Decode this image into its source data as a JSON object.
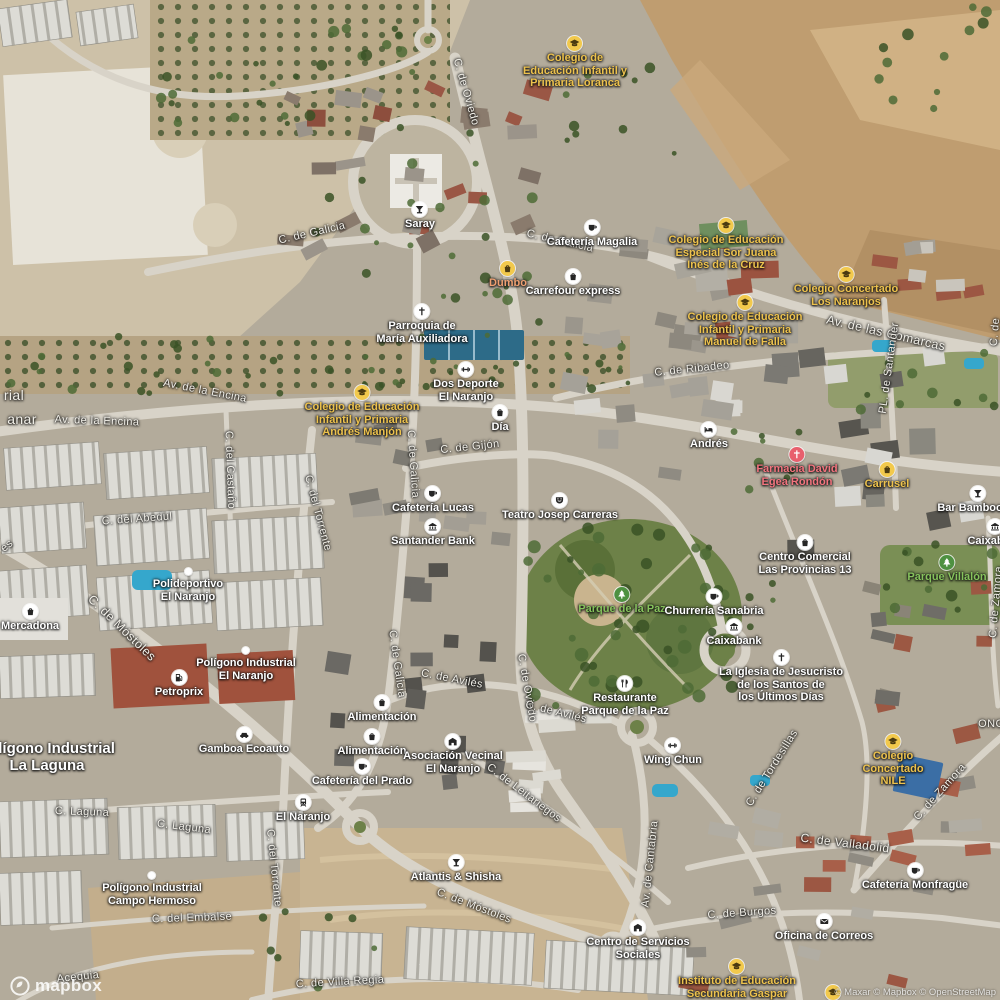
{
  "map": {
    "logo_text": "mapbox",
    "attribution": "© Maxar © Mapbox © OpenStreetMap",
    "palette": {
      "street_text": "#f2f0e9",
      "poi_text": "#ffffff",
      "school_yellow": "#edc24d",
      "park_green": "#86c35c",
      "pharmacy_red": "#f3747e",
      "shop_orange": "#efa071",
      "road": "#d8d3c8"
    },
    "street_labels": [
      {
        "text": "C. de Oviedo",
        "x": 466,
        "y": 92,
        "r": 74
      },
      {
        "text": "C. de Galicia",
        "x": 312,
        "y": 233,
        "r": -13
      },
      {
        "text": "C. de Galicia",
        "x": 560,
        "y": 241,
        "r": 13
      },
      {
        "text": "Av. de las Comarcas",
        "x": 886,
        "y": 333,
        "r": 13,
        "size": 12.5
      },
      {
        "text": "C. de Ribadeo",
        "x": 692,
        "y": 369,
        "r": -6
      },
      {
        "text": "PL. de Santander",
        "x": 889,
        "y": 368,
        "r": -82
      },
      {
        "text": "Av. de la Encina",
        "x": 205,
        "y": 391,
        "r": 11
      },
      {
        "text": "Av. de la Encina",
        "x": 97,
        "y": 421,
        "r": 2
      },
      {
        "text": "C. del Castaño",
        "x": 230,
        "y": 470,
        "r": 88
      },
      {
        "text": "C. del Abedul",
        "x": 137,
        "y": 519,
        "r": -4
      },
      {
        "text": "C. de Galicia",
        "x": 413,
        "y": 464,
        "r": 86
      },
      {
        "text": "C. de Gijón",
        "x": 470,
        "y": 447,
        "r": -6
      },
      {
        "text": "C. del Torrente",
        "x": 318,
        "y": 513,
        "r": 75
      },
      {
        "text": "C. de Móstoles",
        "x": 122,
        "y": 628,
        "r": 44,
        "size": 12.5
      },
      {
        "text": "C. de Galicia",
        "x": 397,
        "y": 664,
        "r": 82
      },
      {
        "text": "C. de Avilés",
        "x": 452,
        "y": 679,
        "r": 11
      },
      {
        "text": "C. de Oviedo",
        "x": 527,
        "y": 688,
        "r": 80
      },
      {
        "text": "C. de Avilés",
        "x": 556,
        "y": 712,
        "r": 14
      },
      {
        "text": "C. de Leitariegos",
        "x": 524,
        "y": 793,
        "r": 37
      },
      {
        "text": "C. de Tordesillas",
        "x": 772,
        "y": 768,
        "r": -58
      },
      {
        "text": "C. del Torrente",
        "x": 274,
        "y": 868,
        "r": 84
      },
      {
        "text": "C. Laguna",
        "x": 82,
        "y": 812,
        "r": 2
      },
      {
        "text": "C. Laguna",
        "x": 184,
        "y": 827,
        "r": 7
      },
      {
        "text": "Av. de Cantabria",
        "x": 650,
        "y": 864,
        "r": -84
      },
      {
        "text": "C. de Móstoles",
        "x": 474,
        "y": 906,
        "r": 21
      },
      {
        "text": "C. de Zamora",
        "x": 940,
        "y": 792,
        "r": -48
      },
      {
        "text": "C. de Valladolid",
        "x": 845,
        "y": 843,
        "r": 7,
        "size": 12
      },
      {
        "text": "C. de Burgos",
        "x": 742,
        "y": 913,
        "r": -4
      },
      {
        "text": "C. del Embalse",
        "x": 192,
        "y": 918,
        "r": -2
      },
      {
        "text": "C. de Villa Regia",
        "x": 340,
        "y": 982,
        "r": -3
      },
      {
        "text": "Acequia",
        "x": 78,
        "y": 977,
        "r": -6
      },
      {
        "text": "C. de Zamora",
        "x": 996,
        "y": 602,
        "r": -85
      },
      {
        "text": "C. de",
        "x": 995,
        "y": 332,
        "r": -85
      },
      {
        "text": "rial",
        "x": 14,
        "y": 395,
        "r": 0,
        "size": 14
      },
      {
        "text": "anar",
        "x": 22,
        "y": 419,
        "r": 0,
        "size": 14
      },
      {
        "text": "es",
        "x": 7,
        "y": 546,
        "r": -40
      },
      {
        "text": "ONC",
        "x": 991,
        "y": 724,
        "r": 0
      }
    ],
    "poi_labels": [
      {
        "lines": [
          "Saray"
        ],
        "x": 420,
        "y": 210,
        "icon": "bar"
      },
      {
        "lines": [
          "Cafetería Magalia"
        ],
        "x": 592,
        "y": 228,
        "icon": "cafe"
      },
      {
        "lines": [
          "Dumbo"
        ],
        "x": 508,
        "y": 269,
        "icon": "shop",
        "color": "#efa071"
      },
      {
        "lines": [
          "Carrefour express"
        ],
        "x": 573,
        "y": 277,
        "icon": "grocery"
      },
      {
        "lines": [
          "Parroquia de",
          "María Auxiliadora"
        ],
        "x": 422,
        "y": 312,
        "icon": "church"
      },
      {
        "lines": [
          "Colegio de",
          "Educación Infantil y",
          "Primaria Loranca"
        ],
        "x": 575,
        "y": 44,
        "icon": "school",
        "color": "#edc24d"
      },
      {
        "lines": [
          "Colegio de Educación",
          "Especial Sor Juana",
          "Inés de la Cruz"
        ],
        "x": 726,
        "y": 226,
        "icon": "school",
        "color": "#edc24d"
      },
      {
        "lines": [
          "Colegio Concertado",
          "Los Naranjos"
        ],
        "x": 846,
        "y": 275,
        "icon": "school",
        "color": "#edc24d"
      },
      {
        "lines": [
          "Colegio de Educación",
          "Infantil y Primaria",
          "Manuel de Falla"
        ],
        "x": 745,
        "y": 303,
        "icon": "school",
        "color": "#edc24d"
      },
      {
        "lines": [
          "Dos Deporte",
          "El Naranjo"
        ],
        "x": 466,
        "y": 370,
        "icon": "fitness"
      },
      {
        "lines": [
          "Día"
        ],
        "x": 500,
        "y": 413,
        "icon": "grocery"
      },
      {
        "lines": [
          "Colegio de Educación",
          "Infantil y Primaria",
          "Andrés Manjón"
        ],
        "x": 362,
        "y": 393,
        "icon": "school",
        "color": "#edc24d"
      },
      {
        "lines": [
          "Andrés"
        ],
        "x": 709,
        "y": 430,
        "icon": "lodging"
      },
      {
        "lines": [
          "Farmacia David",
          "Egea Rondón"
        ],
        "x": 797,
        "y": 455,
        "icon": "pharmacy",
        "color": "#f3747e"
      },
      {
        "lines": [
          "Carrusel"
        ],
        "x": 887,
        "y": 470,
        "icon": "shop",
        "color": "#edc24d"
      },
      {
        "lines": [
          "Bar Bamboo Gr"
        ],
        "x": 978,
        "y": 494,
        "icon": "bar"
      },
      {
        "lines": [
          "Caixabank"
        ],
        "x": 995,
        "y": 527,
        "icon": "bank"
      },
      {
        "lines": [
          "Parque Villalón"
        ],
        "x": 947,
        "y": 563,
        "icon": "park",
        "color": "#86c35c"
      },
      {
        "lines": [
          "Cafetería Lucas"
        ],
        "x": 433,
        "y": 494,
        "icon": "cafe"
      },
      {
        "lines": [
          "Santander Bank"
        ],
        "x": 433,
        "y": 527,
        "icon": "bank"
      },
      {
        "lines": [
          "Teatro Josep Carreras"
        ],
        "x": 560,
        "y": 501,
        "icon": "theatre"
      },
      {
        "lines": [
          "Centro Comercial",
          "Las Provincias 13"
        ],
        "x": 805,
        "y": 543,
        "icon": "shop2"
      },
      {
        "lines": [
          "Parque de la Paz"
        ],
        "x": 622,
        "y": 595,
        "icon": "park",
        "color": "#86c35c"
      },
      {
        "lines": [
          "Churrería Sanabria"
        ],
        "x": 714,
        "y": 597,
        "icon": "cafe"
      },
      {
        "lines": [
          "Caixabank"
        ],
        "x": 734,
        "y": 627,
        "icon": "bank"
      },
      {
        "lines": [
          "La Iglesia de Jesucristo",
          "de los Santos de",
          "los Últimos Días"
        ],
        "x": 781,
        "y": 658,
        "icon": "church"
      },
      {
        "lines": [
          "Restaurante",
          "Parque de la Paz"
        ],
        "x": 625,
        "y": 684,
        "icon": "restaurant"
      },
      {
        "lines": [
          "Wing Chun"
        ],
        "x": 673,
        "y": 746,
        "icon": "fitness"
      },
      {
        "lines": [
          "Mercadona"
        ],
        "x": 30,
        "y": 612,
        "icon": "grocery"
      },
      {
        "lines": [
          "Alimentación"
        ],
        "x": 382,
        "y": 703,
        "icon": "grocery"
      },
      {
        "lines": [
          "Alimentación"
        ],
        "x": 372,
        "y": 737,
        "icon": "grocery"
      },
      {
        "lines": [
          "Asociación Vecinal",
          "El Naranjo"
        ],
        "x": 453,
        "y": 742,
        "icon": "building"
      },
      {
        "lines": [
          "Cafetería del Prado"
        ],
        "x": 362,
        "y": 767,
        "icon": "cafe"
      },
      {
        "lines": [
          "El Naranjo"
        ],
        "x": 303,
        "y": 803,
        "icon": "rail"
      },
      {
        "lines": [
          "Petroprix"
        ],
        "x": 179,
        "y": 678,
        "icon": "fuel"
      },
      {
        "lines": [
          "Gamboa Ecoauto"
        ],
        "x": 244,
        "y": 735,
        "icon": "car"
      },
      {
        "lines": [
          "Atlantis & Shisha"
        ],
        "x": 456,
        "y": 863,
        "icon": "bar"
      },
      {
        "lines": [
          "Centro de Servicios",
          "Sociales"
        ],
        "x": 638,
        "y": 928,
        "icon": "building"
      },
      {
        "lines": [
          "Instituto de Educación",
          "Secundaria Gaspar"
        ],
        "x": 737,
        "y": 967,
        "icon": "school",
        "color": "#edc24d"
      },
      {
        "lines": [],
        "x": 833,
        "y": 993,
        "icon": "school"
      },
      {
        "lines": [
          "Colegio",
          "Concertado",
          "NILE"
        ],
        "x": 893,
        "y": 742,
        "icon": "school",
        "color": "#edc24d"
      },
      {
        "lines": [
          "Cafetería Monfragüe"
        ],
        "x": 915,
        "y": 871,
        "icon": "cafe"
      },
      {
        "lines": [
          "Oficina de Correos"
        ],
        "x": 824,
        "y": 922,
        "icon": "mail"
      },
      {
        "lines": [
          "Polideportivo",
          "El Naranjo"
        ],
        "x": 188,
        "y": 572,
        "icon": "dot"
      },
      {
        "lines": [
          "Polígono Industrial",
          "El Naranjo"
        ],
        "x": 246,
        "y": 651,
        "icon": "dot"
      },
      {
        "lines": [
          "Polígono Industrial",
          "Campo Hermoso"
        ],
        "x": 152,
        "y": 876,
        "icon": "dot"
      },
      {
        "lines": [
          "Polígono Industrial",
          "La Laguna"
        ],
        "x": 47,
        "y": 740,
        "icon": "none",
        "size": 15
      }
    ]
  }
}
